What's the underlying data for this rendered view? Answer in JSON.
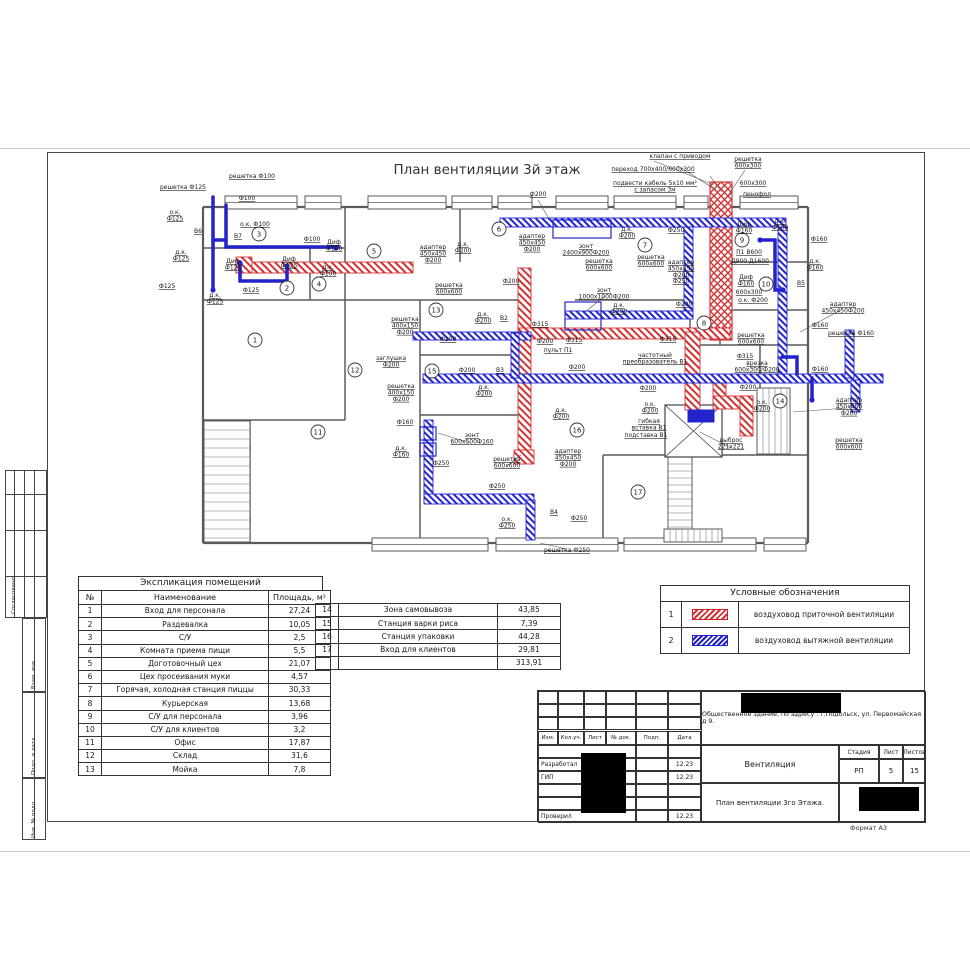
{
  "colors": {
    "supply": "#d23333",
    "exhaust": "#2323cc"
  },
  "frame": {
    "stamps": [
      "Согласовано",
      "Взам. инв.",
      "Подп. и дата",
      "Инв. № подл."
    ]
  },
  "plan": {
    "title": "План вентиляции 3й этаж",
    "walls": [
      [
        203,
        207,
        808,
        207
      ],
      [
        203,
        207,
        203,
        543
      ],
      [
        203,
        543,
        808,
        543
      ],
      [
        808,
        207,
        808,
        543
      ],
      [
        203,
        248,
        345,
        248
      ],
      [
        310,
        248,
        310,
        300
      ],
      [
        345,
        207,
        345,
        300
      ],
      [
        460,
        207,
        460,
        262
      ],
      [
        203,
        300,
        530,
        300
      ],
      [
        345,
        300,
        345,
        420
      ],
      [
        203,
        420,
        345,
        420
      ],
      [
        250,
        420,
        250,
        543
      ],
      [
        420,
        300,
        420,
        543
      ],
      [
        420,
        355,
        530,
        355
      ],
      [
        420,
        415,
        530,
        415
      ],
      [
        530,
        300,
        530,
        420
      ],
      [
        575,
        300,
        690,
        300
      ],
      [
        720,
        207,
        720,
        345
      ],
      [
        690,
        300,
        690,
        405
      ],
      [
        720,
        262,
        808,
        262
      ],
      [
        720,
        310,
        808,
        310
      ],
      [
        690,
        345,
        808,
        345
      ],
      [
        760,
        345,
        760,
        455
      ],
      [
        603,
        455,
        808,
        455
      ],
      [
        603,
        455,
        603,
        543
      ]
    ],
    "windows_top": [
      [
        225,
        196,
        72
      ],
      [
        305,
        196,
        36
      ],
      [
        368,
        196,
        78
      ],
      [
        452,
        196,
        40
      ],
      [
        498,
        196,
        34
      ],
      [
        556,
        196,
        52
      ],
      [
        614,
        196,
        62
      ],
      [
        684,
        196,
        24
      ],
      [
        740,
        196,
        58
      ]
    ],
    "windows_bottom": [
      [
        372,
        538,
        116
      ],
      [
        496,
        538,
        122
      ],
      [
        624,
        538,
        132
      ],
      [
        764,
        538,
        42
      ]
    ],
    "red_unit": [
      710,
      182,
      22,
      158
    ],
    "red_rects": [
      [
        243,
        262,
        170,
        11
      ],
      [
        518,
        268,
        13,
        188
      ],
      [
        518,
        328,
        212,
        11
      ],
      [
        685,
        332,
        15,
        78
      ],
      [
        713,
        376,
        13,
        30
      ],
      [
        713,
        396,
        40,
        13
      ],
      [
        740,
        396,
        13,
        40
      ],
      [
        236,
        257,
        16,
        16
      ],
      [
        514,
        450,
        20,
        14
      ]
    ],
    "blue_rects": [
      [
        500,
        218,
        286,
        9
      ],
      [
        778,
        227,
        9,
        150
      ],
      [
        684,
        227,
        9,
        88
      ],
      [
        565,
        311,
        128,
        8
      ],
      [
        423,
        374,
        460,
        9
      ],
      [
        413,
        332,
        118,
        8
      ],
      [
        511,
        333,
        8,
        45
      ],
      [
        845,
        330,
        9,
        48
      ],
      [
        851,
        380,
        9,
        32
      ],
      [
        424,
        420,
        9,
        80
      ],
      [
        424,
        494,
        110,
        10
      ],
      [
        526,
        500,
        9,
        40
      ]
    ],
    "blue_outlines": [
      [
        553,
        220,
        58,
        18
      ],
      [
        565,
        302,
        36,
        28
      ],
      [
        420,
        427,
        16,
        13
      ],
      [
        420,
        443,
        16,
        13
      ]
    ],
    "fan_rect": [
      688,
      410,
      26,
      12
    ],
    "blue_lines": [
      [
        [
          213,
          197
        ],
        [
          213,
          290
        ]
      ],
      [
        [
          213,
          240
        ],
        [
          226,
          240
        ]
      ],
      [
        [
          226,
          205
        ],
        [
          226,
          247
        ]
      ],
      [
        [
          226,
          247
        ],
        [
          338,
          247
        ]
      ],
      [
        [
          240,
          262
        ],
        [
          240,
          281
        ],
        [
          287,
          281
        ],
        [
          287,
          266
        ]
      ],
      [
        [
          782,
          357
        ],
        [
          797,
          357
        ],
        [
          797,
          374
        ]
      ],
      [
        [
          760,
          240
        ],
        [
          775,
          240
        ],
        [
          775,
          290
        ],
        [
          783,
          290
        ]
      ],
      [
        [
          812,
          378
        ],
        [
          812,
          400
        ]
      ]
    ],
    "dots": [
      [
        240,
        263
      ],
      [
        287,
        266
      ],
      [
        336,
        248
      ],
      [
        213,
        290
      ],
      [
        760,
        240
      ],
      [
        783,
        290
      ],
      [
        812,
        400
      ]
    ],
    "stairs": [
      [
        204,
        421,
        46,
        121,
        "h",
        9
      ],
      [
        668,
        457,
        24,
        72,
        "h",
        7
      ],
      [
        757,
        388,
        33,
        66,
        "v",
        6
      ],
      [
        664,
        529,
        58,
        13,
        "v",
        6
      ]
    ],
    "shaft": [
      665,
      405,
      57,
      52
    ],
    "leaders": [
      [
        678,
        166,
        716,
        190
      ],
      [
        710,
        176,
        722,
        192
      ],
      [
        745,
        170,
        727,
        197
      ],
      [
        538,
        200,
        549,
        219
      ],
      [
        605,
        296,
        585,
        312
      ],
      [
        731,
        448,
        700,
        432
      ],
      [
        567,
        549,
        540,
        543
      ],
      [
        841,
        310,
        800,
        332
      ],
      [
        846,
        408,
        793,
        412
      ],
      [
        470,
        443,
        438,
        433
      ],
      [
        508,
        465,
        521,
        455
      ],
      [
        654,
        161,
        714,
        185
      ]
    ],
    "rooms": [
      [
        1,
        255,
        340
      ],
      [
        2,
        287,
        288
      ],
      [
        3,
        259,
        234
      ],
      [
        4,
        319,
        284
      ],
      [
        5,
        374,
        251
      ],
      [
        6,
        499,
        229
      ],
      [
        7,
        645,
        245
      ],
      [
        8,
        704,
        323
      ],
      [
        9,
        742,
        240
      ],
      [
        10,
        766,
        284
      ],
      [
        11,
        318,
        432
      ],
      [
        12,
        355,
        370
      ],
      [
        13,
        436,
        310
      ],
      [
        14,
        780,
        401
      ],
      [
        15,
        432,
        371
      ],
      [
        16,
        577,
        430
      ],
      [
        17,
        638,
        492
      ]
    ],
    "annotations": [
      [
        "решетка Ф125",
        183,
        189
      ],
      [
        "решетка Ф100",
        252,
        178
      ],
      [
        "Ф100",
        247,
        200
      ],
      [
        "о.к.\nФ125",
        175,
        214
      ],
      [
        "B6",
        198,
        233
      ],
      [
        "о.к. Ф100",
        255,
        226
      ],
      [
        "B7",
        238,
        238
      ],
      [
        "Ф100",
        312,
        241
      ],
      [
        "д.к.\nФ125",
        181,
        254
      ],
      [
        "Диф\nФ125",
        233,
        263
      ],
      [
        "Диф\nФ125",
        289,
        261
      ],
      [
        "Диф\nФ100",
        334,
        244
      ],
      [
        "д.к.\nФ100",
        328,
        269
      ],
      [
        "Ф125",
        167,
        288
      ],
      [
        "д.к.\nФ125",
        215,
        297
      ],
      [
        "Ф125",
        251,
        292
      ],
      [
        "адаптер\n450x450\nФ200",
        433,
        249
      ],
      [
        "д.к.\nФ200",
        463,
        246
      ],
      [
        "решетка\n600x600",
        449,
        287
      ],
      [
        "Ф200",
        511,
        283
      ],
      [
        "Ф200",
        538,
        196
      ],
      [
        "адаптер\n450x450\nФ200",
        532,
        238
      ],
      [
        "зонт\n2400x900Ф200",
        586,
        248
      ],
      [
        "решетка\n600x600",
        599,
        263
      ],
      [
        "д.к.\nФ200",
        627,
        231
      ],
      [
        "решетка\n600x600",
        651,
        259
      ],
      [
        "Ф250",
        676,
        232
      ],
      [
        "адаптер\n450x450\nФ200\nФ250",
        681,
        264
      ],
      [
        "зонт\n1000x1000Ф200",
        604,
        292
      ],
      [
        "д.к.\nФ200",
        619,
        307
      ],
      [
        "Ф200",
        684,
        306
      ],
      [
        "клапан с приводом",
        680,
        158
      ],
      [
        "переход 700x400/600x300",
        653,
        171
      ],
      [
        "подвести кабель 5x10 мм²\nс запасом 3м",
        655,
        185
      ],
      [
        "решетка\n600x300",
        748,
        161
      ],
      [
        "600x300",
        753,
        185
      ],
      [
        "пенофол",
        757,
        196
      ],
      [
        "Диф\nФ160",
        744,
        226
      ],
      [
        "д.к.\nФ160",
        780,
        223
      ],
      [
        "Ф160",
        819,
        241
      ],
      [
        "П1 В600",
        749,
        254
      ],
      [
        "Д900 Д1600",
        750,
        263
      ],
      [
        "Диф\nФ160",
        746,
        279
      ],
      [
        "д.к.\nФ160",
        815,
        263
      ],
      [
        "B5",
        801,
        285
      ],
      [
        "600x300",
        749,
        294
      ],
      [
        "о.к. Ф200",
        753,
        302
      ],
      [
        "адаптер\n450x450Ф200",
        843,
        306
      ],
      [
        "Ф160",
        820,
        327
      ],
      [
        "решетка Ф160",
        851,
        335
      ],
      [
        "решетка\n600x600",
        751,
        337
      ],
      [
        "Ф160",
        820,
        371
      ],
      [
        "врезка\n600x300/Ф200",
        757,
        365
      ],
      [
        "Ф315",
        540,
        326
      ],
      [
        "Ф315",
        574,
        342
      ],
      [
        "Ф315",
        668,
        341
      ],
      [
        "Ф315",
        745,
        358
      ],
      [
        "пульт П1",
        558,
        352
      ],
      [
        "частотный\nпреобразователь В1",
        655,
        357
      ],
      [
        "Ф200",
        545,
        343
      ],
      [
        "Ф200",
        577,
        369
      ],
      [
        "Ф200",
        648,
        390
      ],
      [
        "о.к.\nФ200",
        650,
        406
      ],
      [
        "Ф200",
        748,
        389
      ],
      [
        "о.к.\nФ200",
        762,
        404
      ],
      [
        "гибкая\nвставка В1",
        649,
        423
      ],
      [
        "подставка В1",
        646,
        437
      ],
      [
        "выброс\n221x221",
        731,
        442
      ],
      [
        "адаптер\n450x450\nФ200",
        849,
        402
      ],
      [
        "решетка\n600x600",
        849,
        442
      ],
      [
        "решетка\n400x150\nФ200",
        405,
        321
      ],
      [
        "д.к.\nФ200",
        483,
        316
      ],
      [
        "B2",
        504,
        320
      ],
      [
        "Ф200",
        448,
        341
      ],
      [
        "заглушка\nФ200",
        391,
        360
      ],
      [
        "решетка\n400x150\nФ200",
        401,
        388
      ],
      [
        "Ф200",
        467,
        372
      ],
      [
        "B3",
        500,
        372
      ],
      [
        "д.к.\nФ200",
        484,
        389
      ],
      [
        "Ф160",
        405,
        424
      ],
      [
        "д.к.\nФ160",
        401,
        450
      ],
      [
        "зонт\n600x500Ф160",
        472,
        437
      ],
      [
        "Ф250",
        441,
        465
      ],
      [
        "решетка\n600x600",
        507,
        461
      ],
      [
        "адаптер\n450x450\nФ200",
        568,
        453
      ],
      [
        "д.к.\nФ200",
        561,
        412
      ],
      [
        "Ф250",
        497,
        488
      ],
      [
        "о.к.\nФ250",
        507,
        521
      ],
      [
        "B4",
        554,
        514
      ],
      [
        "Ф250",
        579,
        520
      ],
      [
        "решетка Ф250",
        567,
        552
      ]
    ]
  },
  "explication": {
    "title": "Экспликация помещений",
    "headers": [
      "№",
      "Наименование",
      "Площадь, м²"
    ],
    "rows_left": [
      [
        "1",
        "Вход для персонала",
        "27,24"
      ],
      [
        "2",
        "Раздевалка",
        "10,05"
      ],
      [
        "3",
        "С/У",
        "2,5"
      ],
      [
        "4",
        "Комната приема пищи",
        "5,5"
      ],
      [
        "5",
        "Доготовочный цех",
        "21,07"
      ],
      [
        "6",
        "Цех просеивания муки",
        "4,57"
      ],
      [
        "7",
        "Горячая, холодная станция пиццы",
        "30,33"
      ],
      [
        "8",
        "Курьерская",
        "13,68"
      ],
      [
        "9",
        "С/У для персонала",
        "3,96"
      ],
      [
        "10",
        "С/У для клиентов",
        "3,2"
      ],
      [
        "11",
        "Офис",
        "17,87"
      ],
      [
        "12",
        "Склад",
        "31,6"
      ],
      [
        "13",
        "Мойка",
        "7,8"
      ]
    ],
    "rows_right": [
      [
        "14",
        "Зона самовывоза",
        "43,85"
      ],
      [
        "15",
        "Станция варки риса",
        "7,39"
      ],
      [
        "16",
        "Станция упаковки",
        "44,28"
      ],
      [
        "17",
        "Вход для клиентов",
        "29,81"
      ],
      [
        "",
        "",
        "313,91"
      ]
    ]
  },
  "legend": {
    "title": "Условные обозначения",
    "items": [
      {
        "num": "1",
        "type": "supply",
        "label": "воздуховод приточной вентиляции"
      },
      {
        "num": "2",
        "type": "exhaust",
        "label": "воздуховод вытяжной вентиляции"
      }
    ]
  },
  "titleblock": {
    "address": "Общественное здание, по адресу : г.Подольск, ул. Первомайская д 9.",
    "cols": [
      "Изм.",
      "Кол.уч.",
      "Лист",
      "№ док.",
      "Подп.",
      "Дата"
    ],
    "rows": [
      {
        "role": "",
        "date": ""
      },
      {
        "role": "Разработал",
        "date": "12.23"
      },
      {
        "role": "ГИП",
        "date": "12.23"
      },
      {
        "role": "",
        "date": ""
      },
      {
        "role": "",
        "date": ""
      },
      {
        "role": "Проверил",
        "date": "12.23"
      }
    ],
    "project": "Вентиляция",
    "stage": {
      "headers": [
        "Стадия",
        "Лист",
        "Листов"
      ],
      "values": [
        "РП",
        "5",
        "15"
      ]
    },
    "sheet_title": "План вентиляции 3го Этажа.",
    "format": "Формат А3"
  }
}
